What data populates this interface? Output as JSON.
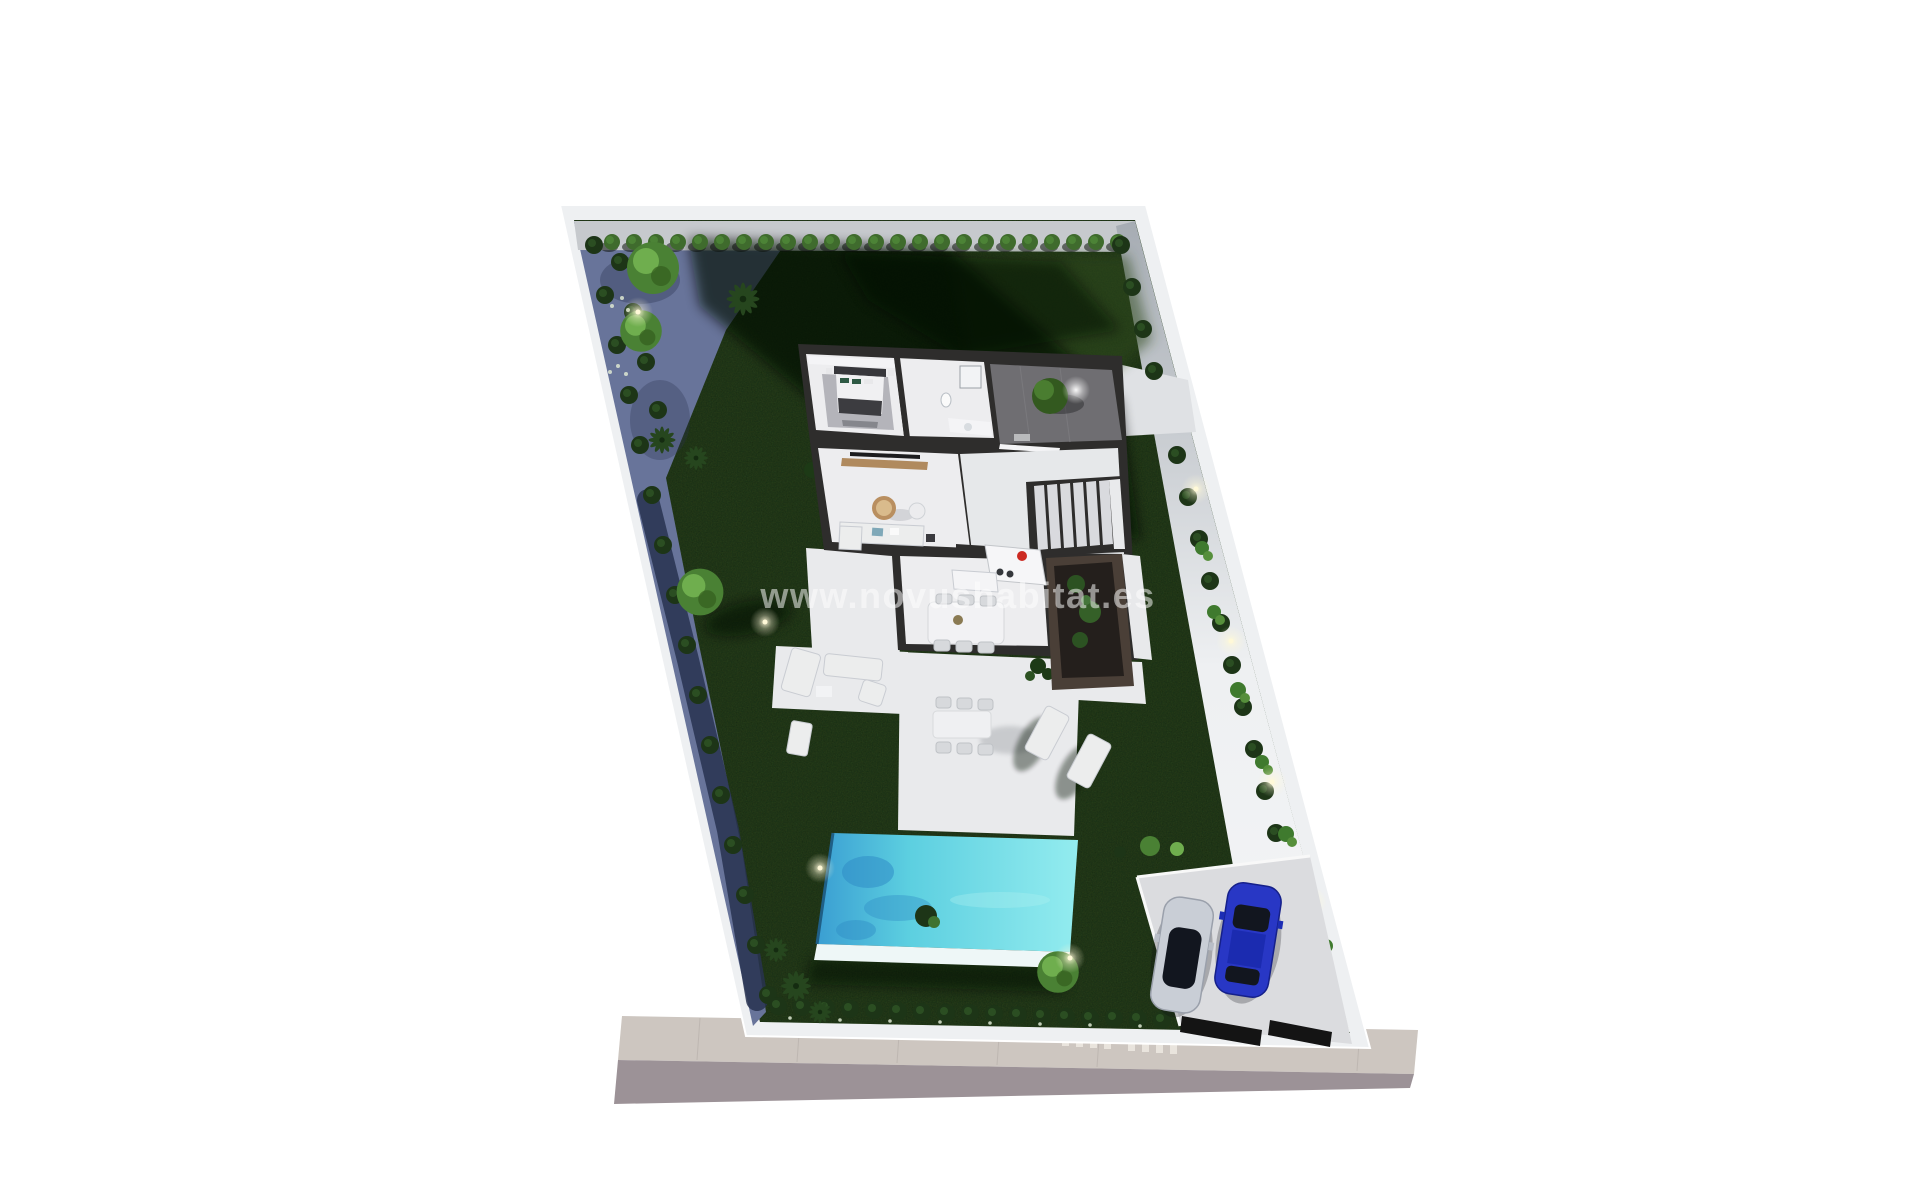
{
  "watermark": {
    "text": "www.novushabitat.es"
  },
  "palette": {
    "background": "#ffffff",
    "wall": "#eef0f2",
    "wallShade": "#c6c9cd",
    "lawn": "#1b2a12",
    "lawnLight": "#2e4a1e",
    "shadow": "#060c05",
    "leftGround": "#68749a",
    "leftGroundDark": "#283250",
    "hedge": "#3f6b2d",
    "hedgeDark": "#1d3517",
    "tree": "#4a8134",
    "treeLight": "#6fae4e",
    "palm": "#26461e",
    "poolDeep": "#3a9ed2",
    "poolMain": "#5ccfe0",
    "poolShallow": "#93ecef",
    "poolRim": "#eef7f7",
    "terrace": "#e9eaec",
    "houseWall": "#2e2d2c",
    "floor": "#ededef",
    "courtyard": "#6f6e72",
    "wood": "#b08a5e",
    "accentRed": "#cc2a22",
    "sofaBlue": "#7fa8b8",
    "pad": "#dbdcdf",
    "carSilver": "#c9ced6",
    "carBlue": "#2837c5",
    "carGlass": "#12161f",
    "sidewalk": "#cdc6c0",
    "roadFace": "#9c9297",
    "watermarkColor": "#ffffff",
    "lightGlow": "#fff9d8"
  }
}
